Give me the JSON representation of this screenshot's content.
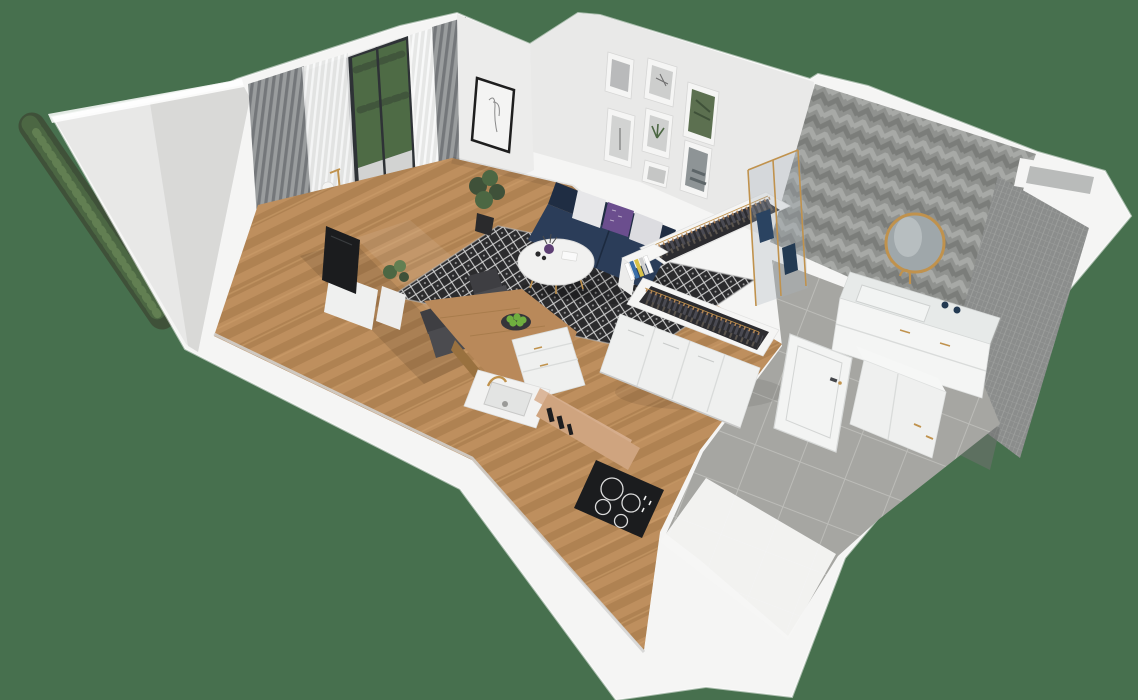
{
  "scene": {
    "title": "isometric-3d-apartment-floorplan-render",
    "rooms": {
      "balcony": {
        "objects": [
          "hedge-plants",
          "balcony-floor"
        ]
      },
      "living_room": {
        "objects": [
          "glass-balcony-door",
          "blackout-curtains",
          "sheer-curtains",
          "floor-lamp",
          "portrait-frame",
          "gallery-wall",
          "navy-sofa",
          "pillows",
          "diamond-rug",
          "round-coffee-table",
          "purple-vase",
          "corner-plant",
          "tv",
          "tv-cabinet",
          "herringbone-wood-floor"
        ],
        "gallery_frame_count": 7,
        "pillow_count": 3
      },
      "kitchen": {
        "objects": [
          "wood-dining-counter",
          "fruit-bowl",
          "dining-chairs",
          "drawer-unit",
          "sink",
          "gold-faucet",
          "counter-bottles",
          "induction-cooktop"
        ],
        "chair_count": 2,
        "burner_count": 4
      },
      "wardrobe": {
        "objects": [
          "open-clothes-rack-upper",
          "open-clothes-rack-lower",
          "hanging-clothes",
          "book-stack",
          "base-cabinets"
        ],
        "rack_count": 2
      },
      "bathroom": {
        "objects": [
          "chevron-tile-wall",
          "mosaic-tile-wall",
          "round-gold-mirror",
          "vanity",
          "gold-faucet",
          "soap-bottles",
          "shower-glass",
          "blue-towels",
          "washer-cabinet",
          "open-door",
          "wall-niche"
        ],
        "towel_count": 2
      },
      "hallway": {
        "objects": [
          "gray-tile-floor",
          "entry-slab"
        ]
      }
    }
  },
  "palette": {
    "bg_green": "#47704e",
    "wall": "#f5f5f4",
    "wall_top": "#ffffff",
    "left_wall_light": "#e8e8e7",
    "left_wall_dark": "#cccccb",
    "recess": "#d9dad9",
    "inner_wall": "#ececeb",
    "gallery_wall": "#e9e9e8",
    "curtain_dark": "#74777a",
    "curtain_mid": "#9a9d9e",
    "sheer": "#e3e4e4",
    "door_frame": "#2e3236",
    "glass_green": "#4e6b45",
    "green_dark": "#3f5139",
    "green_mid": "#4c6743",
    "green_light": "#627f52",
    "balcony_floor": "#d2d3d2",
    "wood": "#b9895a",
    "wood_dark": "#99713f",
    "wood_light": "#cda06b",
    "tile": "#a6a6a2",
    "tile_grout": "#bcbcb8",
    "rug": "#2b2b2d",
    "rug_line": "#d0d0d0",
    "sofa_back": "#1f2d43",
    "sofa_seat": "#2b3d59",
    "pillow": "#e7e7e9",
    "pillow_alt": "#dcdce0",
    "purple": "#6b4e8e",
    "table_white": "#f1f1f0",
    "vase_purple": "#5d3f74",
    "candle_dark": "#2a2a2c",
    "chair": "#4b4b4f",
    "chair_dark": "#3e3e42",
    "cabinet_white": "#eff0ef",
    "seam": "#d9dbda",
    "counter_tan": "#cfa47f",
    "backsplash": "#d8b091",
    "bottle_dark": "#1d1d1f",
    "cooktop": "#1b1c1e",
    "burner": "#dcdcdc",
    "sink_inner": "#e3e4e3",
    "gold": "#c0924d",
    "clothes_dark": "#2c2c30",
    "clothes_mid": "#4a4a52",
    "clothes_light": "#5a544d",
    "hanger": "#b28457",
    "book_blue": "#3a6ea8",
    "book_yellow": "#d8c24a",
    "chevron_base": "#90928f",
    "chevron_light": "#a7a9a6",
    "chevron_dark": "#7b7d7a",
    "mosaic": "#8b8d8c",
    "mosaic_line": "#9fa19f",
    "niche_inner": "#b9bbba",
    "mirror_glass": "#9fa7aa",
    "mirror_hi": "#c4cbcc",
    "marble": "#e7eae9",
    "towel": "#2a4361",
    "towel_dark": "#233a52",
    "glass_blue": "#aab4bc",
    "apple": "#6fae3f",
    "bowl": "#35353a"
  }
}
